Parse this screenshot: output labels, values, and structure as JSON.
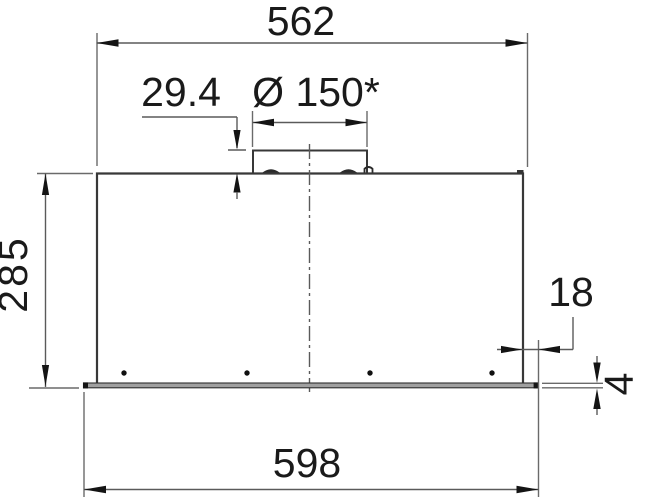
{
  "drawing": {
    "type": "technical-installation-drawing",
    "view": "front-elevation-of-built-in-hood",
    "labels": {
      "top_width": "562",
      "collar_height": "29.4",
      "duct_diameter": "Ø 150*",
      "body_height": "285",
      "edge_inset": "18",
      "flange_thickness": "4",
      "bottom_width": "598"
    },
    "colors": {
      "object_line": "#383838",
      "dimension_line": "#5a5a5a",
      "text": "#1a1a1a",
      "flange_fill": "#a0a0a0",
      "background": "#ffffff"
    }
  }
}
